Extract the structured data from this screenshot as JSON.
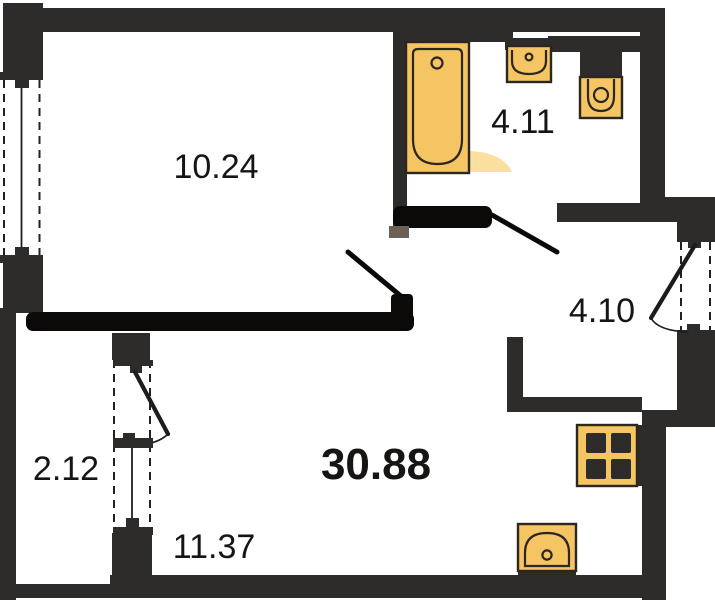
{
  "plan": {
    "type": "apartment-floor-plan",
    "total_area": "30.88",
    "rooms": {
      "living": {
        "area": "10.24"
      },
      "bathroom": {
        "area": "4.11"
      },
      "hallway": {
        "area": "4.10"
      },
      "balcony": {
        "area": "2.12"
      },
      "kitchen": {
        "area": "11.37"
      }
    },
    "fixtures": [
      "bathtub-icon",
      "wash-basin-icon",
      "toilet-icon",
      "stove-icon",
      "kitchen-sink-icon"
    ],
    "openings": [
      "living-window",
      "balcony-door-window-block",
      "entrance-door",
      "bathroom-door",
      "living-room-door"
    ],
    "colors": {
      "wall": "#2e2c2a",
      "marker": "#0b0a09",
      "fixture_fill": "#f5c463",
      "fixture_fill_light": "#f9d98e",
      "fixture_stroke": "#2b2620",
      "text": "#161514",
      "background": "#ffffff"
    }
  }
}
